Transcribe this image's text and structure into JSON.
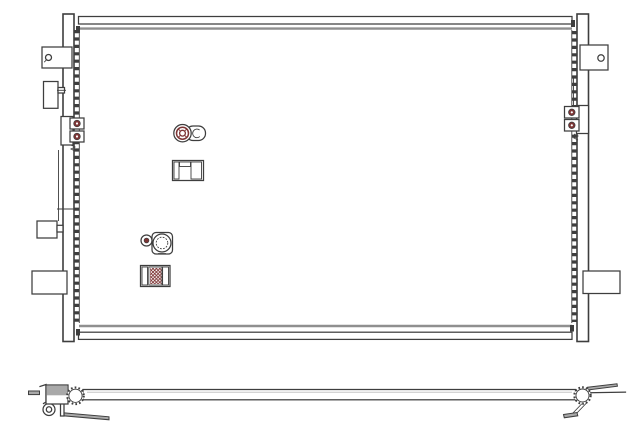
{
  "colors": {
    "background": "#ffffff",
    "white": "#ffffff",
    "line": "#3e3e3e",
    "gray": "#8f8f8f",
    "gray_fill": "#a9a9a9",
    "gray_light": "#c6c6c6",
    "accent": "#7d3535"
  },
  "diagram": {
    "type": "technical-line-drawing",
    "views": [
      {
        "name": "front-view",
        "components": [
          "left-header-tank",
          "right-header-tank",
          "top-tube",
          "bottom-tube",
          "fin-serration-left",
          "fin-serration-right",
          "mount-bracket-top-left",
          "side-bracket-left",
          "clamp-bracket-left",
          "mid-bracket-left",
          "lower-bracket-left",
          "mount-bracket-top-right",
          "clamp-bracket-right",
          "lower-bracket-right",
          "upper-port-fitting",
          "upper-section-fitting",
          "lower-flange-fitting",
          "lower-section-fitting"
        ]
      },
      {
        "name": "side-view",
        "components": [
          "tube-profile",
          "left-end-mount",
          "left-pin",
          "left-gear-fitting",
          "left-foot",
          "right-gear-fitting",
          "right-rod",
          "right-foot"
        ]
      }
    ]
  }
}
